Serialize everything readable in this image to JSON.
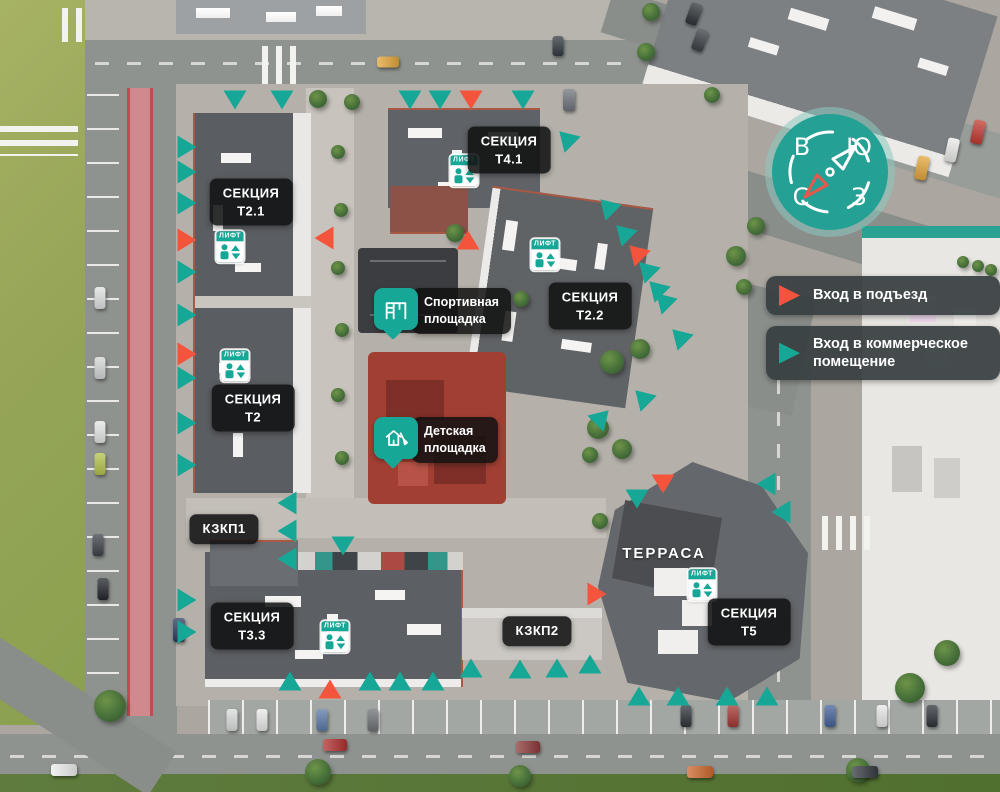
{
  "colors": {
    "teal": "#17A796",
    "red": "#F4543C",
    "label_bg": "rgba(17,18,18,0.88)",
    "legend_bg": "rgba(54,62,64,0.92)"
  },
  "legend": {
    "items": [
      {
        "id": "entrance",
        "color": "#F4543C",
        "label": "Вход в подъезд",
        "icon": "red-triangle-icon"
      },
      {
        "id": "commercial",
        "color": "#17A796",
        "label": "Вход в коммерческое помещение",
        "icon": "teal-triangle-icon"
      }
    ]
  },
  "compass": {
    "letters": {
      "nw": "В",
      "ne": "Ю",
      "sw": "С",
      "se": "З"
    }
  },
  "sections": [
    {
      "id": "t2-1",
      "lines": [
        "СЕКЦИЯ",
        "Т2.1"
      ],
      "x": 251,
      "y": 202
    },
    {
      "id": "t4-1",
      "lines": [
        "СЕКЦИЯ",
        "Т4.1"
      ],
      "x": 509,
      "y": 150
    },
    {
      "id": "t2-2",
      "lines": [
        "СЕКЦИЯ",
        "Т2.2"
      ],
      "x": 590,
      "y": 306
    },
    {
      "id": "t2",
      "lines": [
        "СЕКЦИЯ",
        "Т2"
      ],
      "x": 253,
      "y": 408
    },
    {
      "id": "kzkp1",
      "lines": [
        "КЗКП1"
      ],
      "x": 224,
      "y": 529
    },
    {
      "id": "t3-3",
      "lines": [
        "СЕКЦИЯ",
        "Т3.3"
      ],
      "x": 252,
      "y": 626
    },
    {
      "id": "kzkp2",
      "lines": [
        "КЗКП2"
      ],
      "x": 537,
      "y": 631
    },
    {
      "id": "t5",
      "lines": [
        "СЕКЦИЯ",
        "Т5"
      ],
      "x": 749,
      "y": 622
    },
    {
      "id": "terrace",
      "lines": [
        "ТЕРРАСА"
      ],
      "x": 664,
      "y": 554,
      "plain": true
    }
  ],
  "lift": {
    "label": "ЛИФТ",
    "positions": [
      {
        "x": 230,
        "y": 247
      },
      {
        "x": 464,
        "y": 171
      },
      {
        "x": 545,
        "y": 255
      },
      {
        "x": 235,
        "y": 366
      },
      {
        "x": 335,
        "y": 637
      },
      {
        "x": 702,
        "y": 585
      }
    ]
  },
  "callouts": [
    {
      "id": "sport",
      "lines": [
        "Спортивная",
        "площадка"
      ],
      "icon": "sport-ground-icon",
      "x": 374,
      "y": 288
    },
    {
      "id": "kids",
      "lines": [
        "Детская",
        "площадка"
      ],
      "icon": "kids-ground-icon",
      "x": 374,
      "y": 417
    }
  ],
  "markers": [
    {
      "x": 235,
      "y": 100,
      "c": "t",
      "r": 180
    },
    {
      "x": 282,
      "y": 100,
      "c": "t",
      "r": 180
    },
    {
      "x": 410,
      "y": 100,
      "c": "t",
      "r": 180
    },
    {
      "x": 440,
      "y": 100,
      "c": "t",
      "r": 180
    },
    {
      "x": 471,
      "y": 100,
      "c": "r",
      "r": 180
    },
    {
      "x": 523,
      "y": 100,
      "c": "t",
      "r": 180
    },
    {
      "x": 566,
      "y": 138,
      "c": "t",
      "r": -45
    },
    {
      "x": 187,
      "y": 147,
      "c": "t",
      "r": 90
    },
    {
      "x": 187,
      "y": 172,
      "c": "t",
      "r": 90
    },
    {
      "x": 187,
      "y": 203,
      "c": "t",
      "r": 90
    },
    {
      "x": 187,
      "y": 240,
      "c": "r",
      "r": 90
    },
    {
      "x": 187,
      "y": 272,
      "c": "t",
      "r": 90
    },
    {
      "x": 187,
      "y": 315,
      "c": "t",
      "r": 90
    },
    {
      "x": 187,
      "y": 354,
      "c": "r",
      "r": 90
    },
    {
      "x": 187,
      "y": 378,
      "c": "t",
      "r": 90
    },
    {
      "x": 187,
      "y": 423,
      "c": "t",
      "r": 90
    },
    {
      "x": 187,
      "y": 465,
      "c": "t",
      "r": 90
    },
    {
      "x": 187,
      "y": 600,
      "c": "t",
      "r": 90
    },
    {
      "x": 187,
      "y": 632,
      "c": "t",
      "r": 90
    },
    {
      "x": 324,
      "y": 238,
      "c": "r",
      "r": -90
    },
    {
      "x": 287,
      "y": 503,
      "c": "t",
      "r": -90
    },
    {
      "x": 287,
      "y": 531,
      "c": "t",
      "r": -90
    },
    {
      "x": 287,
      "y": 559,
      "c": "t",
      "r": -90
    },
    {
      "x": 343,
      "y": 546,
      "c": "t",
      "r": 180
    },
    {
      "x": 468,
      "y": 240,
      "c": "r",
      "r": 0
    },
    {
      "x": 607,
      "y": 206,
      "c": "t",
      "r": -45
    },
    {
      "x": 623,
      "y": 232,
      "c": "t",
      "r": -45
    },
    {
      "x": 636,
      "y": 252,
      "c": "r",
      "r": -45
    },
    {
      "x": 646,
      "y": 269,
      "c": "t",
      "r": -45
    },
    {
      "x": 656,
      "y": 288,
      "c": "t",
      "r": -45
    },
    {
      "x": 663,
      "y": 300,
      "c": "t",
      "r": -45
    },
    {
      "x": 679,
      "y": 336,
      "c": "t",
      "r": -45
    },
    {
      "x": 642,
      "y": 397,
      "c": "t",
      "r": -45
    },
    {
      "x": 602,
      "y": 417,
      "c": "t",
      "r": 45
    },
    {
      "x": 663,
      "y": 484,
      "c": "r",
      "r": 180
    },
    {
      "x": 637,
      "y": 499,
      "c": "t",
      "r": 180
    },
    {
      "x": 766,
      "y": 484,
      "c": "t",
      "r": -90
    },
    {
      "x": 781,
      "y": 512,
      "c": "t",
      "r": -90
    },
    {
      "x": 639,
      "y": 696,
      "c": "t",
      "r": 0
    },
    {
      "x": 678,
      "y": 696,
      "c": "t",
      "r": 0
    },
    {
      "x": 727,
      "y": 696,
      "c": "t",
      "r": 0
    },
    {
      "x": 767,
      "y": 696,
      "c": "t",
      "r": 0
    },
    {
      "x": 290,
      "y": 681,
      "c": "t",
      "r": 0
    },
    {
      "x": 330,
      "y": 689,
      "c": "r",
      "r": 0
    },
    {
      "x": 370,
      "y": 681,
      "c": "t",
      "r": 0
    },
    {
      "x": 400,
      "y": 681,
      "c": "t",
      "r": 0
    },
    {
      "x": 433,
      "y": 681,
      "c": "t",
      "r": 0
    },
    {
      "x": 471,
      "y": 668,
      "c": "t",
      "r": 0
    },
    {
      "x": 520,
      "y": 669,
      "c": "t",
      "r": 0
    },
    {
      "x": 557,
      "y": 668,
      "c": "t",
      "r": 0
    },
    {
      "x": 590,
      "y": 664,
      "c": "t",
      "r": 0
    },
    {
      "x": 597,
      "y": 594,
      "c": "r",
      "r": 90
    }
  ],
  "trees": [
    {
      "x": 318,
      "y": 99,
      "r": 9
    },
    {
      "x": 352,
      "y": 102,
      "r": 8
    },
    {
      "x": 338,
      "y": 152,
      "r": 7
    },
    {
      "x": 341,
      "y": 210,
      "r": 7
    },
    {
      "x": 338,
      "y": 268,
      "r": 7
    },
    {
      "x": 342,
      "y": 330,
      "r": 7
    },
    {
      "x": 338,
      "y": 395,
      "r": 7
    },
    {
      "x": 342,
      "y": 458,
      "r": 7
    },
    {
      "x": 455,
      "y": 233,
      "r": 9
    },
    {
      "x": 521,
      "y": 299,
      "r": 8
    },
    {
      "x": 612,
      "y": 362,
      "r": 12
    },
    {
      "x": 640,
      "y": 349,
      "r": 10
    },
    {
      "x": 598,
      "y": 428,
      "r": 11
    },
    {
      "x": 622,
      "y": 449,
      "r": 10
    },
    {
      "x": 590,
      "y": 455,
      "r": 8
    },
    {
      "x": 600,
      "y": 521,
      "r": 8
    },
    {
      "x": 736,
      "y": 256,
      "r": 10
    },
    {
      "x": 756,
      "y": 226,
      "r": 9
    },
    {
      "x": 744,
      "y": 287,
      "r": 8
    },
    {
      "x": 712,
      "y": 95,
      "r": 8
    },
    {
      "x": 651,
      "y": 12,
      "r": 9
    },
    {
      "x": 646,
      "y": 52,
      "r": 9
    },
    {
      "x": 110,
      "y": 706,
      "r": 16
    },
    {
      "x": 318,
      "y": 772,
      "r": 13
    },
    {
      "x": 520,
      "y": 776,
      "r": 11
    },
    {
      "x": 858,
      "y": 770,
      "r": 12
    },
    {
      "x": 910,
      "y": 688,
      "r": 15
    },
    {
      "x": 947,
      "y": 653,
      "r": 13
    },
    {
      "x": 963,
      "y": 262,
      "r": 6
    },
    {
      "x": 978,
      "y": 266,
      "r": 6
    },
    {
      "x": 991,
      "y": 270,
      "r": 6
    }
  ],
  "cars": [
    {
      "x": 388,
      "y": 62,
      "w": 22,
      "h": 11,
      "c": "#E2A63D",
      "r": 0
    },
    {
      "x": 558,
      "y": 46,
      "w": 11,
      "h": 20,
      "c": "#343A41",
      "r": 0
    },
    {
      "x": 569,
      "y": 100,
      "w": 12,
      "h": 22,
      "c": "#70757C",
      "r": 0
    },
    {
      "x": 694,
      "y": 14,
      "w": 12,
      "h": 22,
      "c": "#2E3237",
      "r": 20
    },
    {
      "x": 700,
      "y": 40,
      "w": 12,
      "h": 22,
      "c": "#3A4046",
      "r": 20
    },
    {
      "x": 978,
      "y": 132,
      "w": 12,
      "h": 24,
      "c": "#C03A32",
      "r": 12
    },
    {
      "x": 952,
      "y": 150,
      "w": 12,
      "h": 24,
      "c": "#E9EAE8",
      "r": 12
    },
    {
      "x": 922,
      "y": 168,
      "w": 12,
      "h": 24,
      "c": "#E2A63D",
      "r": 12
    },
    {
      "x": 100,
      "y": 298,
      "w": 11,
      "h": 22,
      "c": "#DFE2E2",
      "r": 0
    },
    {
      "x": 100,
      "y": 368,
      "w": 11,
      "h": 22,
      "c": "#D4D7D7",
      "r": 0
    },
    {
      "x": 100,
      "y": 432,
      "w": 11,
      "h": 22,
      "c": "#E4E6E5",
      "r": 0
    },
    {
      "x": 100,
      "y": 464,
      "w": 11,
      "h": 22,
      "c": "#B5C24C",
      "r": 0
    },
    {
      "x": 98,
      "y": 545,
      "w": 11,
      "h": 22,
      "c": "#3E444B",
      "r": 0
    },
    {
      "x": 103,
      "y": 589,
      "w": 11,
      "h": 22,
      "c": "#23272C",
      "r": 0
    },
    {
      "x": 179,
      "y": 630,
      "w": 12,
      "h": 24,
      "c": "#2C3E60",
      "r": 0
    },
    {
      "x": 64,
      "y": 770,
      "w": 26,
      "h": 12,
      "c": "#ECEEED",
      "r": 0
    },
    {
      "x": 335,
      "y": 745,
      "w": 24,
      "h": 12,
      "c": "#B03030",
      "r": 0
    },
    {
      "x": 528,
      "y": 747,
      "w": 24,
      "h": 12,
      "c": "#8E3A3A",
      "r": 0
    },
    {
      "x": 700,
      "y": 772,
      "w": 26,
      "h": 12,
      "c": "#CC6A2F",
      "r": 0
    },
    {
      "x": 865,
      "y": 772,
      "w": 26,
      "h": 12,
      "c": "#363C42",
      "r": 0
    },
    {
      "x": 232,
      "y": 720,
      "w": 11,
      "h": 22,
      "c": "#DADCDB",
      "r": 0
    },
    {
      "x": 262,
      "y": 720,
      "w": 11,
      "h": 22,
      "c": "#E8E9E8",
      "r": 0
    },
    {
      "x": 322,
      "y": 720,
      "w": 11,
      "h": 22,
      "c": "#5B7BA8",
      "r": 0
    },
    {
      "x": 373,
      "y": 720,
      "w": 11,
      "h": 22,
      "c": "#6E7276",
      "r": 0
    },
    {
      "x": 686,
      "y": 716,
      "w": 11,
      "h": 22,
      "c": "#30353B",
      "r": 0
    },
    {
      "x": 733,
      "y": 716,
      "w": 11,
      "h": 22,
      "c": "#A23833",
      "r": 0
    },
    {
      "x": 830,
      "y": 716,
      "w": 11,
      "h": 22,
      "c": "#46629B",
      "r": 0
    },
    {
      "x": 882,
      "y": 716,
      "w": 11,
      "h": 22,
      "c": "#E6E7E6",
      "r": 0
    },
    {
      "x": 932,
      "y": 716,
      "w": 11,
      "h": 22,
      "c": "#2F343A",
      "r": 0
    }
  ]
}
